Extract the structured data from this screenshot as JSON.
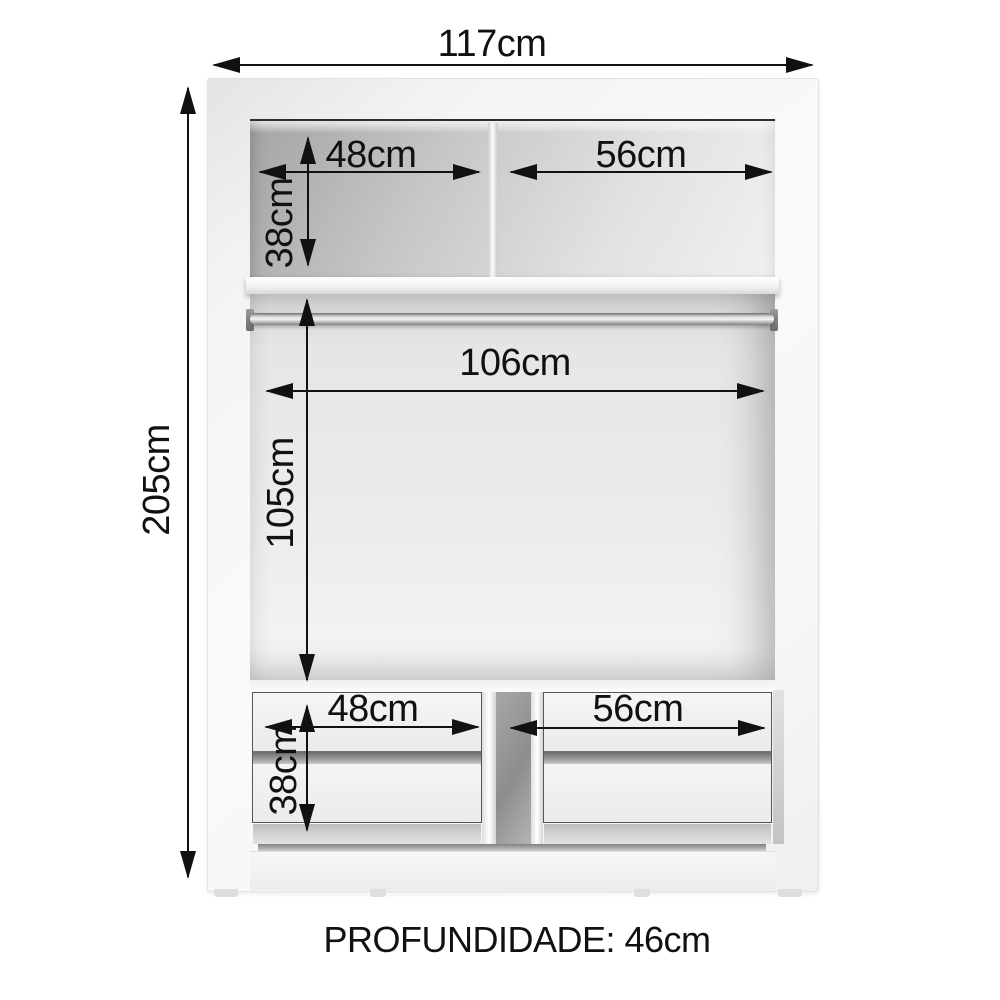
{
  "wardrobe": {
    "type_note": "internal dimension diagram of a wardrobe",
    "dimensions": {
      "overall_width": "117cm",
      "overall_height": "205cm",
      "upper_left_compartment_width": "48cm",
      "upper_right_compartment_width": "56cm",
      "upper_compartment_height": "38cm",
      "hanging_area_width": "106cm",
      "hanging_area_height": "105cm",
      "lower_left_drawer_width": "48cm",
      "lower_right_drawer_width": "56cm",
      "lower_drawer_section_height": "38cm"
    },
    "depth_label": "PROFUNDIDADE: 46cm",
    "colors": {
      "ink": "#111111",
      "cabinet_white": "#f8f8f8",
      "interior_shadow_gray": "#a6a6a6",
      "chrome_rod": "#d9d9d9",
      "background": "#ffffff"
    }
  }
}
